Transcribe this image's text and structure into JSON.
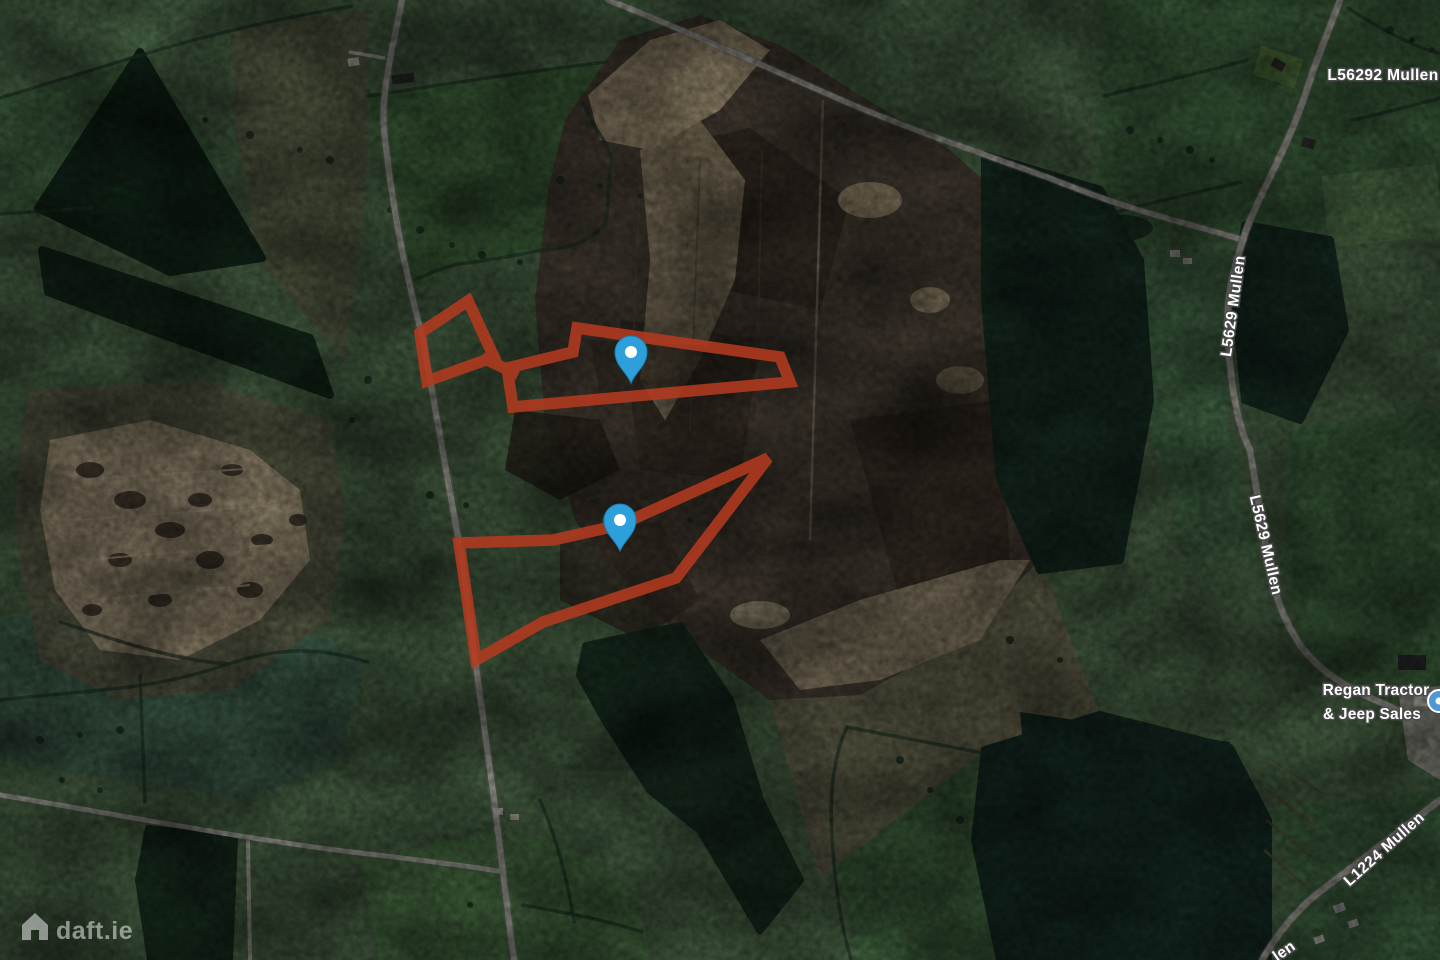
{
  "map": {
    "type": "satellite",
    "watermark": {
      "text": "daft.ie",
      "icon": "house-icon"
    },
    "road_labels": [
      {
        "text": "L56292 Mullen"
      },
      {
        "text": "L5629 Mullen"
      },
      {
        "text": "L5629 Mullen"
      },
      {
        "text": "L1224 Mullen"
      },
      {
        "text": "len"
      }
    ],
    "poi": {
      "line1": "Regan Tractor",
      "line2": "& Jeep Sales",
      "icon": "business-poi-icon"
    },
    "colors": {
      "parcel_outline": "#b23a1f",
      "pin": "#2da0dc",
      "pin_inner": "#ffffff",
      "road": "#cbcac0",
      "label_text": "#ffffff",
      "label_halo": "#4a4a4a",
      "poi_icon_blue": "#4e98d6"
    },
    "parcels": {
      "stroke_width": 11.5,
      "opacity": 0.88,
      "shapes": [
        {
          "id": "parcel-upper-west",
          "closed": true,
          "points": [
            [
              468,
              301
            ],
            [
              420,
              333
            ],
            [
              427,
              381
            ],
            [
              494,
              357
            ]
          ]
        },
        {
          "id": "parcel-upper-link",
          "closed": false,
          "points": [
            [
              487,
              360
            ],
            [
              513,
              372
            ]
          ]
        },
        {
          "id": "parcel-upper-main",
          "closed": true,
          "points": [
            [
              577,
              328
            ],
            [
              780,
              357
            ],
            [
              790,
              382
            ],
            [
              513,
              407
            ],
            [
              507,
              368
            ],
            [
              573,
              352
            ]
          ]
        },
        {
          "id": "parcel-lower",
          "closed": true,
          "points": [
            [
              768,
              458
            ],
            [
              620,
              525
            ],
            [
              553,
              540
            ],
            [
              459,
              543
            ],
            [
              476,
              660
            ],
            [
              543,
              622
            ],
            [
              676,
              578
            ]
          ]
        }
      ]
    },
    "pins": [
      {
        "id": "map-pin-upper",
        "tip_x": 631,
        "tip_y": 383
      },
      {
        "id": "map-pin-lower",
        "tip_x": 620,
        "tip_y": 551
      }
    ]
  }
}
